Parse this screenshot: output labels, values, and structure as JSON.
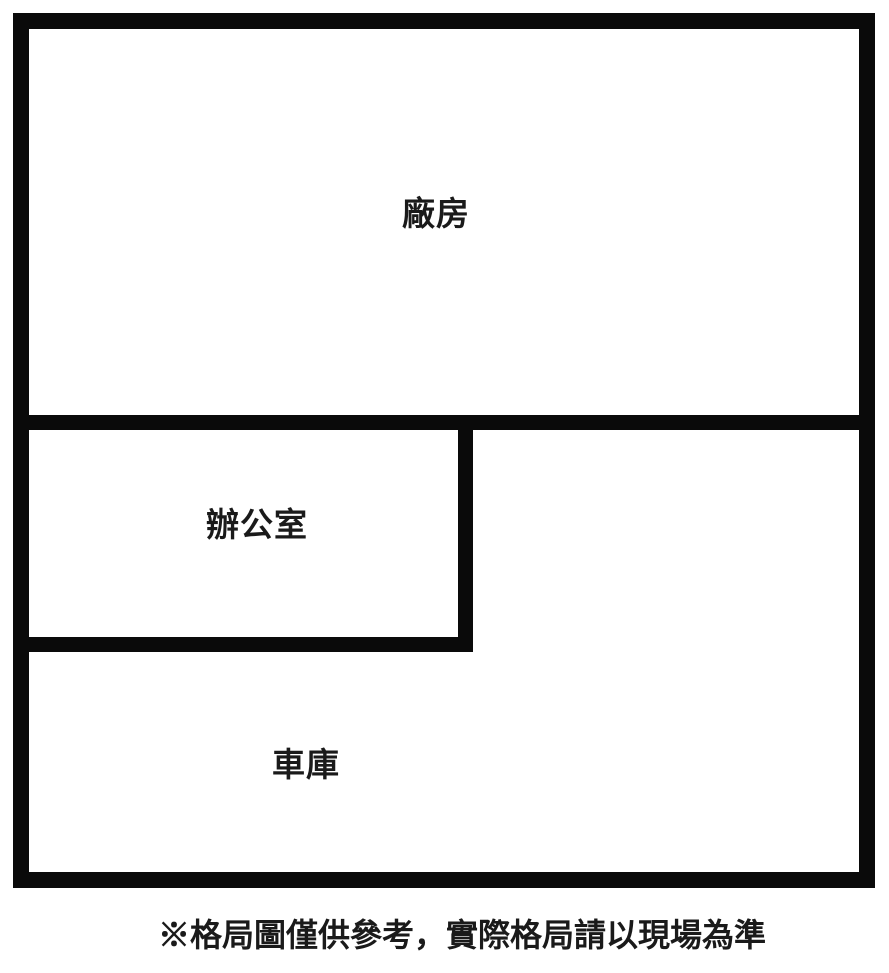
{
  "colors": {
    "wall": "#0a0a0a",
    "background": "#ffffff",
    "text": "#1a1a1a"
  },
  "plan": {
    "rooms": [
      {
        "id": "factory",
        "label": "廠房"
      },
      {
        "id": "office",
        "label": "辦公室"
      },
      {
        "id": "garage",
        "label": "車庫"
      }
    ],
    "disclaimer": "※格局圖僅供參考，實際格局請以現場為準"
  }
}
